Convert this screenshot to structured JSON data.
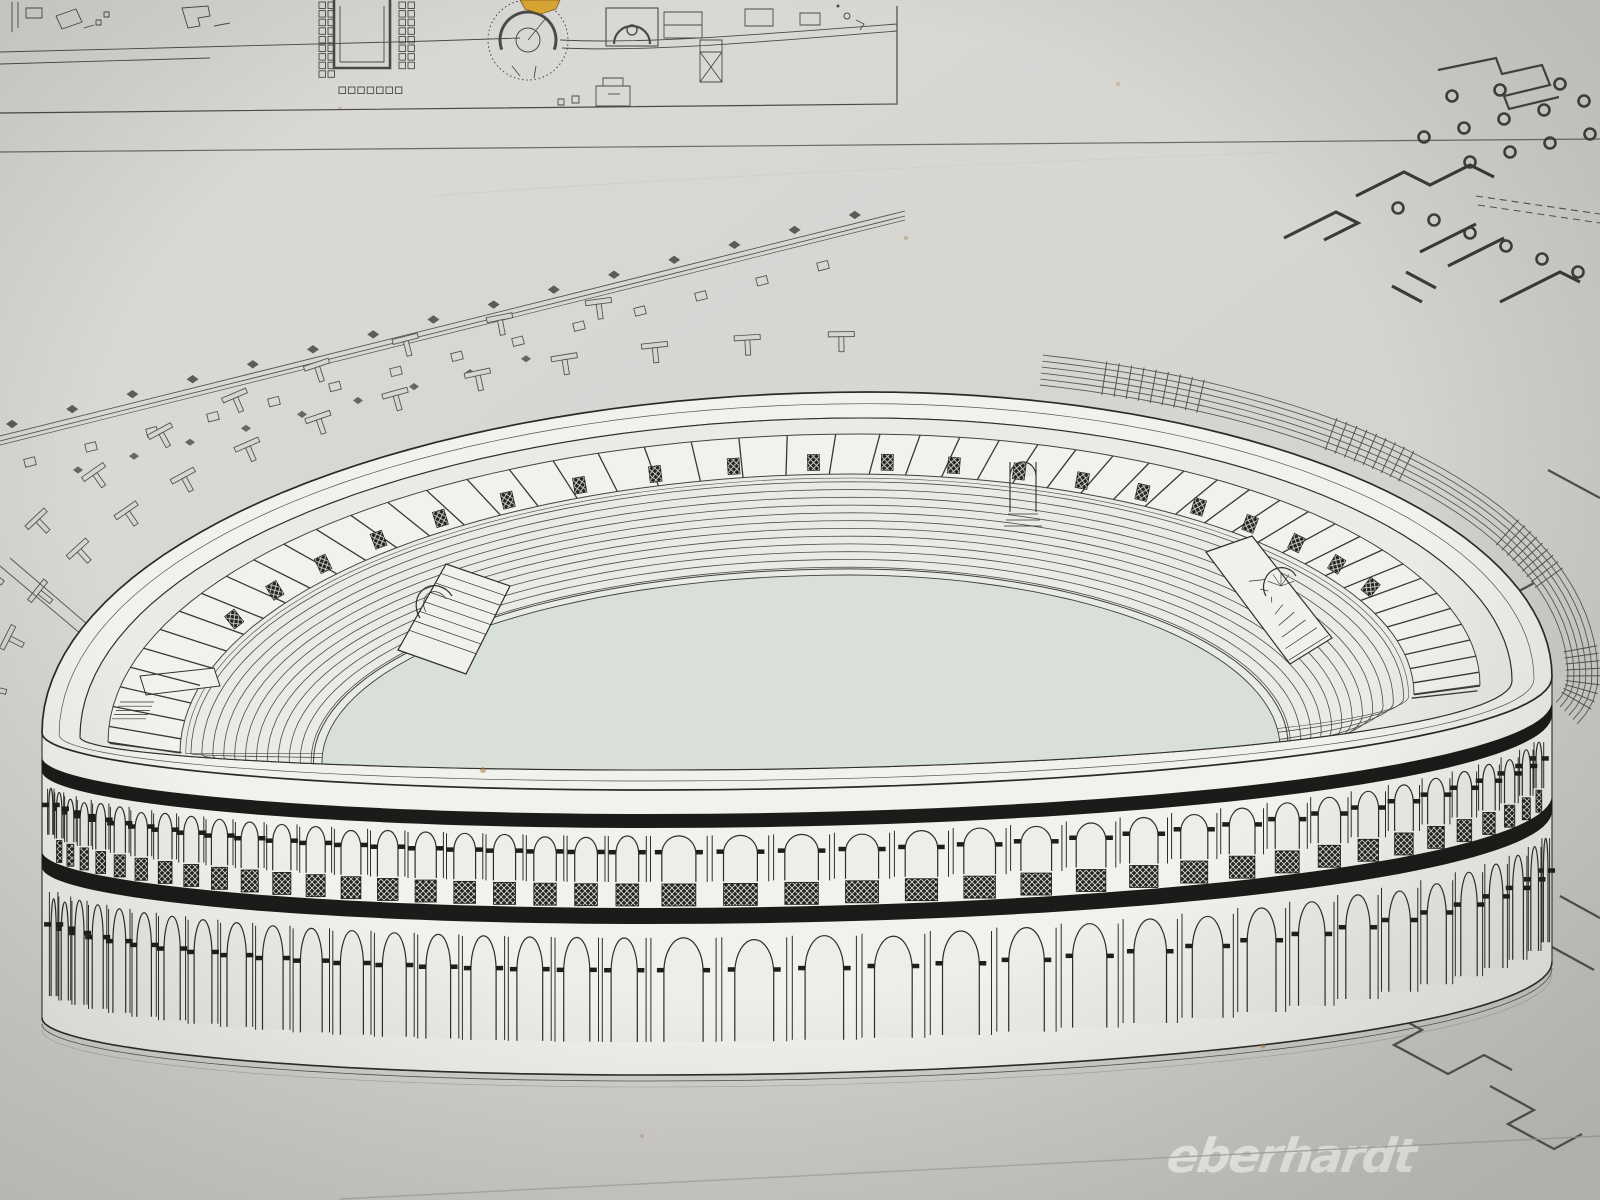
{
  "watermark": {
    "text": "eberhardt",
    "color": "#fafaf8",
    "opacity": 0.93
  },
  "colors": {
    "paper": "#d6d5d2",
    "paper_highlight": "#deddda",
    "paper_shadow": "#c8c7c4",
    "ink_line": "#434341",
    "ink_soft": "#6e6e6b",
    "ink_dark": "#1b1b19",
    "masonry_white": "#f1f1ee",
    "bowl_fill": "#e9ebe6",
    "arena_fill": "#d9e0d8",
    "highlight_building": "#d9a42e",
    "stain": "#a8783f",
    "crease": "#a9a8a5"
  },
  "site_plan_strip": {
    "description": "excavation plan strip with large theatre, odeon and quadriporticus",
    "highlighted_building_color": "#d9a42e",
    "theatre_count": 2
  },
  "illustration": {
    "type": "axonometric-amphitheater-reconstruction",
    "facade": {
      "tier1_arch_count": 46,
      "tier2_arch_count": 40,
      "balustrade_panel_count": 46,
      "string_course_count": 2,
      "wall_drop_px": 285
    },
    "gallery": {
      "post_count": 52,
      "lattice_panel_count": 20
    },
    "seating_row_count": 12,
    "interior_stair_count": 2,
    "vomitorium_arch_count": 3,
    "surroundings": {
      "street_column_diamond_count": 15,
      "street_plinth_count": 14,
      "outer_diamond_row_count": 9,
      "t_column_marks_row1": 14,
      "t_column_marks_row2": 11,
      "ramp_arc_count": 6,
      "ramp_stair_band_count": 4,
      "column_donut_count": 18
    }
  }
}
